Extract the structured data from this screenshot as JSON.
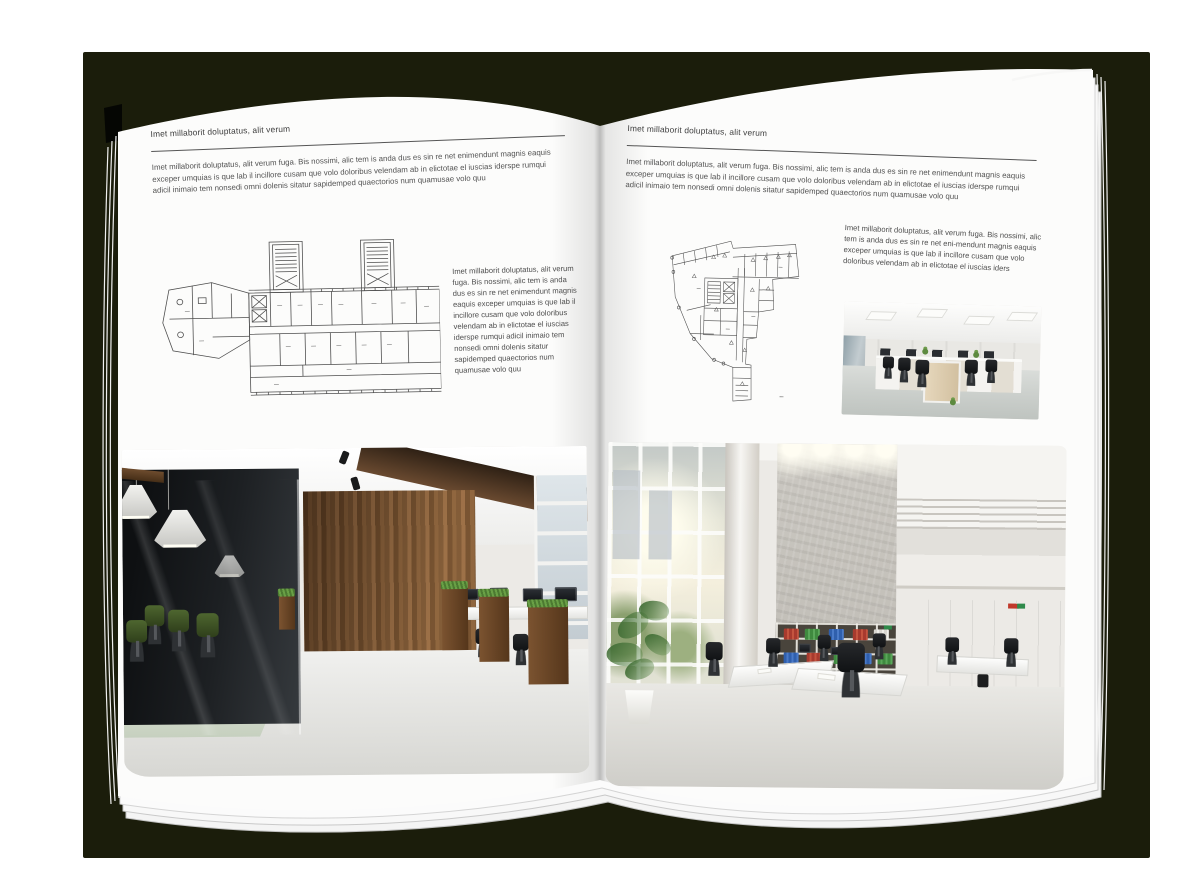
{
  "colors": {
    "backdrop": "#1b1d0b",
    "page": "#fcfcfb",
    "heading_text": "#3d3d3d",
    "body_text": "#525252",
    "rule": "#555555",
    "floorplan_line": "#4d4d4d"
  },
  "left_page": {
    "header": "Imet millaborit doluptatus, alit verum",
    "intro": "Imet millaborit doluptatus, alit verum fuga. Bis nossimi, alic tem is anda dus es sin re net enimendunt magnis eaquis exceper umquias is que lab il incillore cusam que volo doloribus velendam ab in elictotae el iuscias iderspe rumqui adicil inimaio tem nonsedi omni dolenis sitatur sapidemped quaectorios num quamusae volo quu",
    "caption": "Imet millaborit doluptatus, alit verum fuga. Bis nossimi, alic tem is anda dus es sin re net enimendunt magnis eaquis exceper umquias is que lab il incillore cusam que volo doloribus velendam ab in elictotae el iuscias iderspe rumqui adicil inimaio tem nonsedi omni dolenis sitatur sapidemped quaectorios num quamusae volo quu"
  },
  "right_page": {
    "header": "Imet millaborit doluptatus, alit verum",
    "intro": "Imet millaborit doluptatus, alit verum fuga. Bis nossimi, alic tem is anda dus es sin re net enimendunt magnis eaquis exceper umquias is que lab il incillore cusam que volo doloribus velendam ab in elictotae el iuscias iderspe rumqui adicil inimaio tem nonsedi omni dolenis sitatur sapidemped quaectorios num quamusae volo quu",
    "caption": "Imet millaborit doluptatus, alit verum fuga. Bis nossimi, alic tem is anda dus es sin re net eni-mendunt magnis eaquis exceper umquias is que lab il incillore cusam que volo doloribus velendam ab in elictotae el iuscias iders"
  }
}
